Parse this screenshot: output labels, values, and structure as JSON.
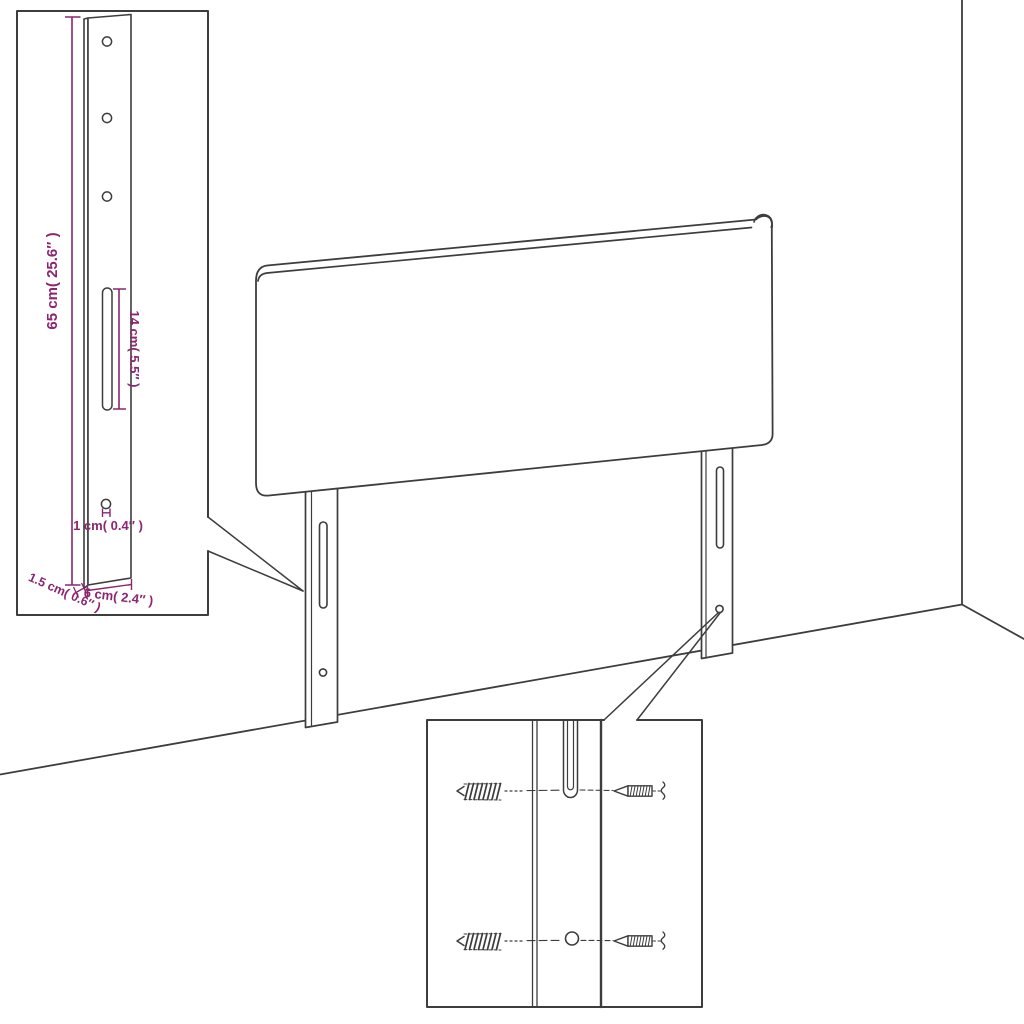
{
  "colors": {
    "line": "#3d3d3d",
    "dimension": "#8b2670",
    "background": "#ffffff"
  },
  "labels": {
    "bracket_height": "65 cm( 25.6″ )",
    "slot_length": "14 cm( 5.5″ )",
    "hole_diameter": "1 cm( 0.4″ )",
    "bracket_thickness": "1.5 cm( 0.6″ )",
    "bracket_width": "6 cm( 2.4″ )"
  }
}
